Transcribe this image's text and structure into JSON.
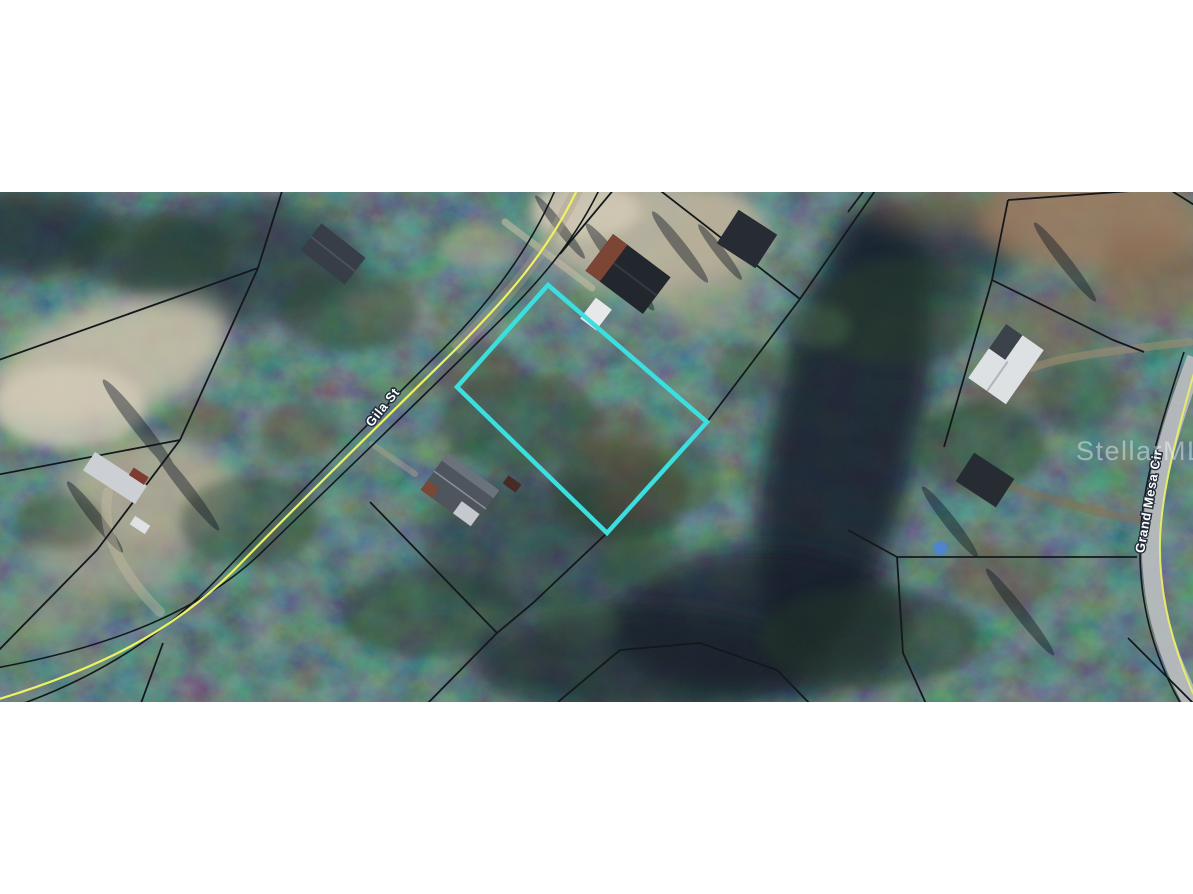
{
  "photo": {
    "kind": "aerial-parcel-map-photo",
    "letterbox_color": "#FFFFFF",
    "watermark": "StellarMLS",
    "streets": [
      {
        "label": "Gila St"
      },
      {
        "label": "Grand Mesa Cir"
      }
    ],
    "highlighted_parcel": {
      "outline_color": "#3BDFE0",
      "corners_px": [
        [
          548,
          285
        ],
        [
          707,
          422
        ],
        [
          607,
          533
        ],
        [
          457,
          387
        ]
      ]
    },
    "map_colors": {
      "forest_base": "#17202E",
      "parcel_line": "#14181D",
      "road_centerline_yellow": "#EDF263",
      "pavement_gray": "#B7BBBD"
    }
  }
}
